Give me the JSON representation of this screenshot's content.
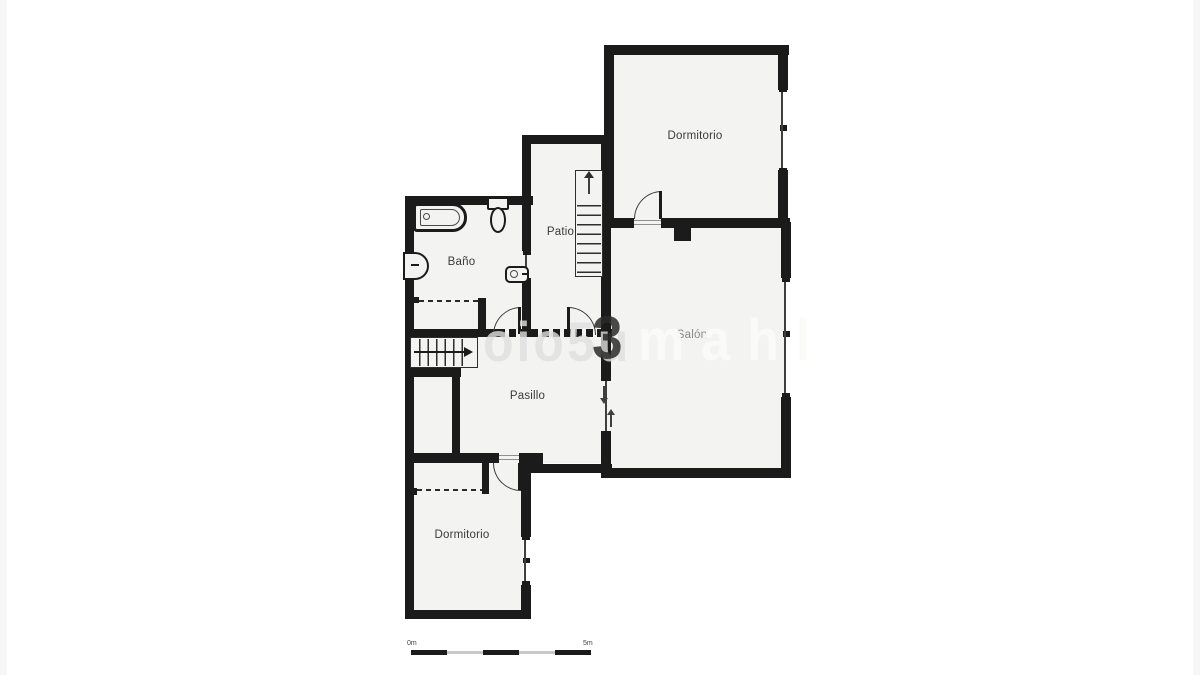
{
  "plan": {
    "rooms": {
      "dormitorio_top": "Dormitorio",
      "patio": "Patio",
      "bano": "Baño",
      "salon": "Salón",
      "pasillo": "Pasillo",
      "dormitorio_bottom": "Dormitorio"
    },
    "watermark": {
      "part1": "oio5u",
      "part2": "3",
      "part3": "mahl"
    },
    "scale_bar": {
      "start": "0m",
      "end": "5m"
    },
    "colors": {
      "wall": "#1b1b1b",
      "floor": "#f3f3f2",
      "label": "#3a3a3a",
      "scale_gray": "#c9c9c9"
    },
    "fixtures": {
      "bathtub": "bathtub-icon",
      "toilet": "toilet-icon",
      "bidet": "bidet-icon",
      "sink": "sink-icon",
      "stairs_patio": "stairs-up-icon",
      "stairs_hall": "stairs-icon"
    }
  }
}
